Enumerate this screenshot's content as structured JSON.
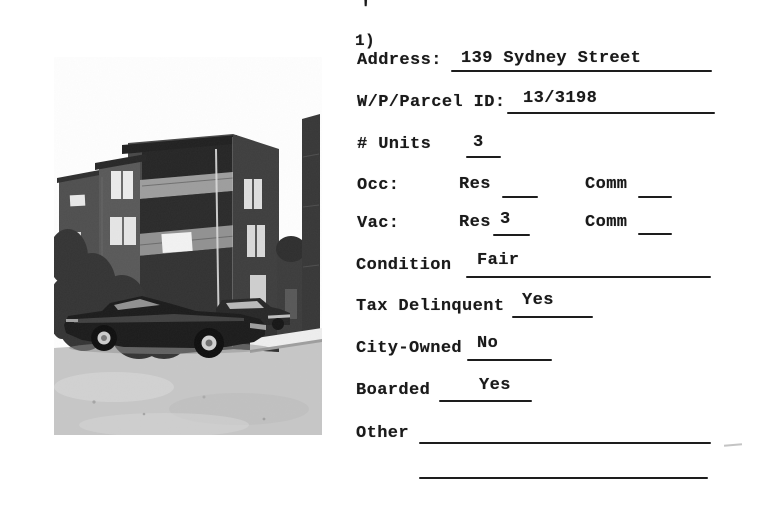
{
  "scan": {
    "stray_mark": "'",
    "item_number": "1)"
  },
  "form": {
    "address": {
      "label": "Address:",
      "value": "139 Sydney Street"
    },
    "parcel_id": {
      "label": "W/P/Parcel ID:",
      "value": "13/3198"
    },
    "units": {
      "label": "# Units",
      "value": "3"
    },
    "occupied": {
      "label": "Occ:",
      "res": {
        "label": "Res",
        "value": ""
      },
      "comm": {
        "label": "Comm",
        "value": ""
      }
    },
    "vacant": {
      "label": "Vac:",
      "res": {
        "label": "Res",
        "value": "3"
      },
      "comm": {
        "label": "Comm",
        "value": ""
      }
    },
    "condition": {
      "label": "Condition",
      "value": "Fair"
    },
    "tax_delinquent": {
      "label": "Tax Delinquent",
      "value": "Yes"
    },
    "city_owned": {
      "label": "City-Owned",
      "value": "No"
    },
    "boarded": {
      "label": "Boarded",
      "value": "Yes"
    },
    "other": {
      "label": "Other",
      "value": ""
    }
  },
  "photo": {
    "description": "black-and-white photograph of a three-story corner apartment building with balconies, trees, and two 1970s cars parked on the street"
  },
  "colors": {
    "ink": "#1a1a1a",
    "paper": "#ffffff"
  }
}
